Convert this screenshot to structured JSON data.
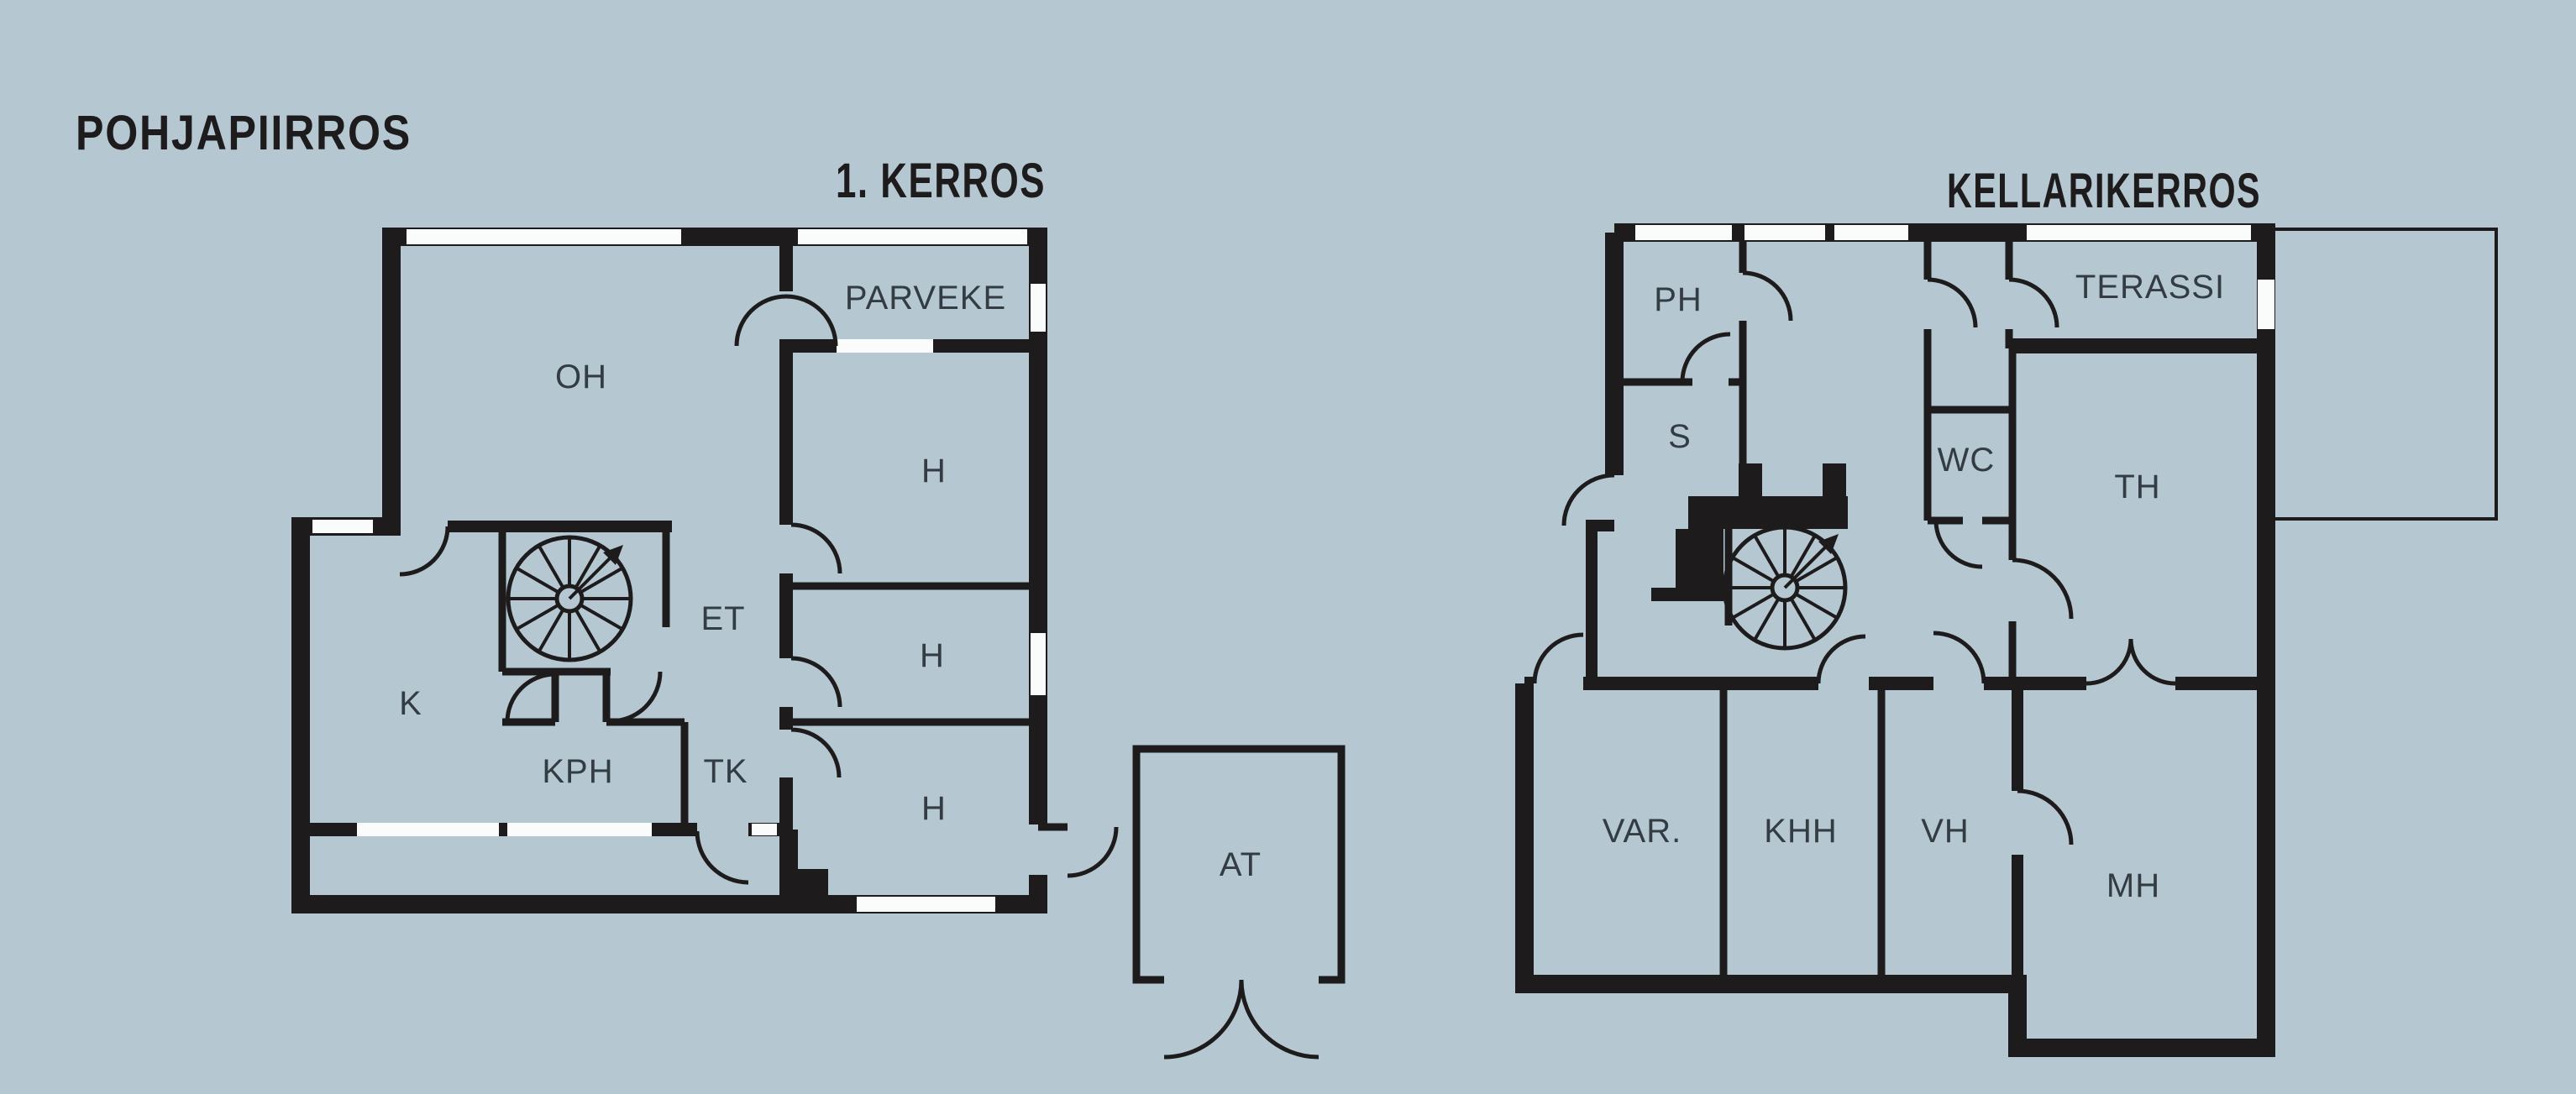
{
  "page_title": "POHJAPIIRROS",
  "colors": {
    "background": "#b5c8d2",
    "walls_ink": "#1d1b1b",
    "room_label": "#333c42",
    "window": "#fafbfb"
  },
  "floor1": {
    "title": "1. KERROS",
    "labels": {
      "oh": "OH",
      "parveke": "PARVEKE",
      "h1": "H",
      "h2": "H",
      "h3": "H",
      "et": "ET",
      "k": "K",
      "kph": "KPH",
      "tk": "TK",
      "at": "AT"
    }
  },
  "basement": {
    "title": "KELLARIKERROS",
    "labels": {
      "ph": "PH",
      "s": "S",
      "wc": "WC",
      "terassi": "TERASSI",
      "th": "TH",
      "var": "VAR.",
      "khh": "KHH",
      "vh": "VH",
      "mh": "MH"
    }
  }
}
